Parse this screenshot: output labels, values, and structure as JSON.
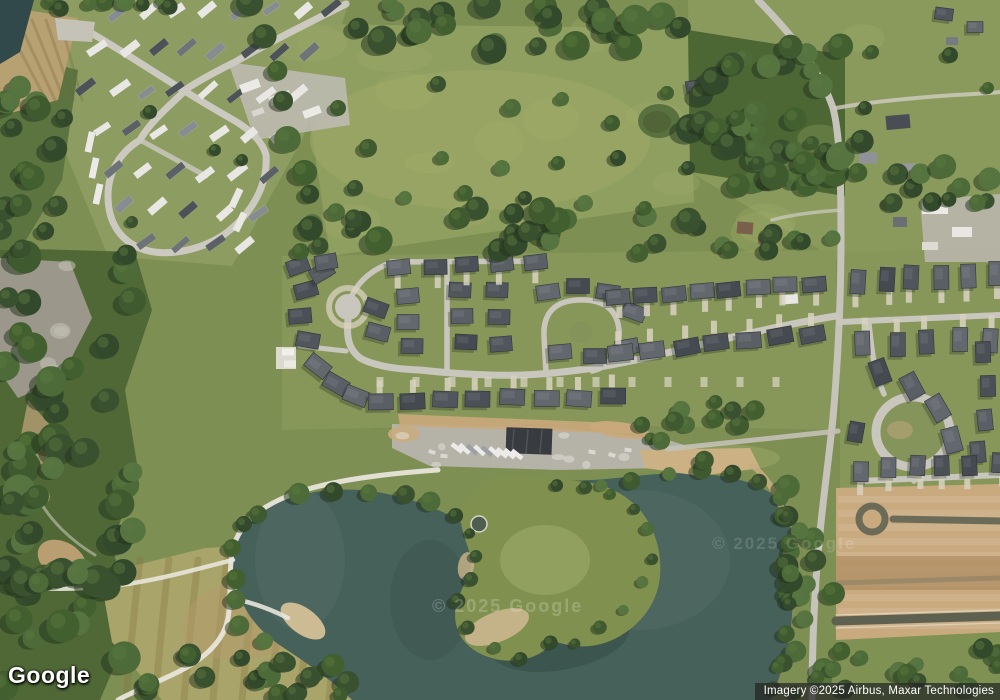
{
  "branding": {
    "logo_text": "Google"
  },
  "watermarks": {
    "center_left": "© 2025 Google",
    "center_right": "© 2025 Google"
  },
  "attribution": {
    "imagery_credit": "Imagery ©2025 Airbus, Maxar Technologies"
  },
  "palette": {
    "grass": "#7e8f53",
    "pasture": "#8f9f60",
    "water": "#46605a",
    "trees": "#3f5a30",
    "road": "#c9c6bd",
    "dirt": "#c9aa7f",
    "roof_dark": "#4b5057",
    "trailer_white": "#e8e7e3",
    "path_white": "#e8e5da"
  }
}
